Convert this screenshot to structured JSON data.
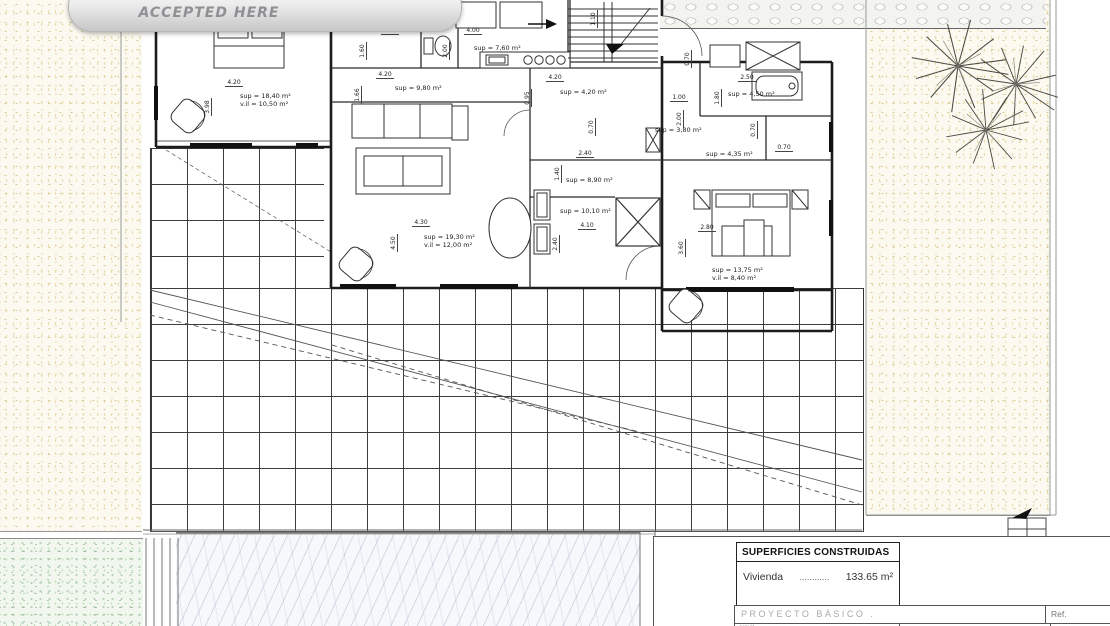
{
  "badge": {
    "label": "ACCEPTED HERE"
  },
  "colors": {
    "sand_dot": "#d8c68e",
    "grass_dot": "#8fbc8f",
    "badge_text": "#8f9094",
    "wall": "#1f1f1f"
  },
  "room_labels": [
    {
      "name": "bedroom-left",
      "l1": "sup = 18,40 m²",
      "l2": "v.il = 10,50 m²",
      "x": 240,
      "y": 92
    },
    {
      "name": "dressing",
      "l1": "sup = 9,80 m²",
      "l2": "",
      "x": 395,
      "y": 84
    },
    {
      "name": "kitchen",
      "l1": "sup = 7,60 m²",
      "l2": "",
      "x": 474,
      "y": 44
    },
    {
      "name": "corridor",
      "l1": "sup = 4,20 m²",
      "l2": "",
      "x": 560,
      "y": 88
    },
    {
      "name": "storage",
      "l1": "sup = 3,80 m²",
      "l2": "",
      "x": 655,
      "y": 126
    },
    {
      "name": "bathroom",
      "l1": "sup = 4,50 m²",
      "l2": "",
      "x": 728,
      "y": 90
    },
    {
      "name": "bathroom-2",
      "l1": "sup = 4,35 m²",
      "l2": "",
      "x": 706,
      "y": 150
    },
    {
      "name": "laundry",
      "l1": "sup = 8,90 m²",
      "l2": "",
      "x": 566,
      "y": 176
    },
    {
      "name": "hall",
      "l1": "sup = 10,10 m²",
      "l2": "",
      "x": 560,
      "y": 207
    },
    {
      "name": "living-room",
      "l1": "sup = 19,30 m²",
      "l2": "v.il = 12,00 m²",
      "x": 424,
      "y": 233
    },
    {
      "name": "bedroom-right",
      "l1": "sup = 13,75 m²",
      "l2": "v.il = 8,40 m²",
      "x": 712,
      "y": 266
    }
  ],
  "dims": [
    {
      "t": "0.70",
      "x": 338,
      "y": 19,
      "o": "h"
    },
    {
      "t": "0.70",
      "x": 360,
      "y": 14,
      "o": "v"
    },
    {
      "t": "4.20",
      "x": 225,
      "y": 79,
      "o": "h"
    },
    {
      "t": "3.98",
      "x": 212,
      "y": 108,
      "o": "v"
    },
    {
      "t": "1.30",
      "x": 381,
      "y": 27,
      "o": "h"
    },
    {
      "t": "1.60",
      "x": 367,
      "y": 52,
      "o": "v"
    },
    {
      "t": "4.00",
      "x": 464,
      "y": 27,
      "o": "h"
    },
    {
      "t": "2.00",
      "x": 450,
      "y": 52,
      "o": "v"
    },
    {
      "t": "4.20",
      "x": 376,
      "y": 71,
      "o": "h"
    },
    {
      "t": "1.66",
      "x": 362,
      "y": 96,
      "o": "v"
    },
    {
      "t": "4.20",
      "x": 546,
      "y": 74,
      "o": "h"
    },
    {
      "t": "0.95",
      "x": 532,
      "y": 99,
      "o": "v"
    },
    {
      "t": "1.10",
      "x": 598,
      "y": 20,
      "o": "v"
    },
    {
      "t": "0.70",
      "x": 692,
      "y": 60,
      "o": "v"
    },
    {
      "t": "1.00",
      "x": 670,
      "y": 94,
      "o": "h"
    },
    {
      "t": "2.00",
      "x": 684,
      "y": 120,
      "o": "v"
    },
    {
      "t": "2.50",
      "x": 738,
      "y": 74,
      "o": "h"
    },
    {
      "t": "1.80",
      "x": 722,
      "y": 99,
      "o": "v"
    },
    {
      "t": "0.70",
      "x": 596,
      "y": 128,
      "o": "v"
    },
    {
      "t": "0.70",
      "x": 758,
      "y": 131,
      "o": "v"
    },
    {
      "t": "0.70",
      "x": 775,
      "y": 144,
      "o": "h"
    },
    {
      "t": "2.40",
      "x": 576,
      "y": 150,
      "o": "h"
    },
    {
      "t": "1.40",
      "x": 562,
      "y": 175,
      "o": "v"
    },
    {
      "t": "4.10",
      "x": 578,
      "y": 222,
      "o": "h"
    },
    {
      "t": "2.40",
      "x": 560,
      "y": 245,
      "o": "v"
    },
    {
      "t": "4.30",
      "x": 412,
      "y": 219,
      "o": "h"
    },
    {
      "t": "4.50",
      "x": 398,
      "y": 244,
      "o": "v"
    },
    {
      "t": "2.80",
      "x": 698,
      "y": 224,
      "o": "h"
    },
    {
      "t": "3.60",
      "x": 686,
      "y": 249,
      "o": "v"
    }
  ],
  "title_block": {
    "header": "SUPERFICIES CONSTRUIDAS",
    "row_label": "Vivienda",
    "row_dots": "............",
    "row_value": "133.65 m²",
    "project": "PROYECTO  BÁSICO  .",
    "ref": "Ref.",
    "partial": "arquit."
  }
}
